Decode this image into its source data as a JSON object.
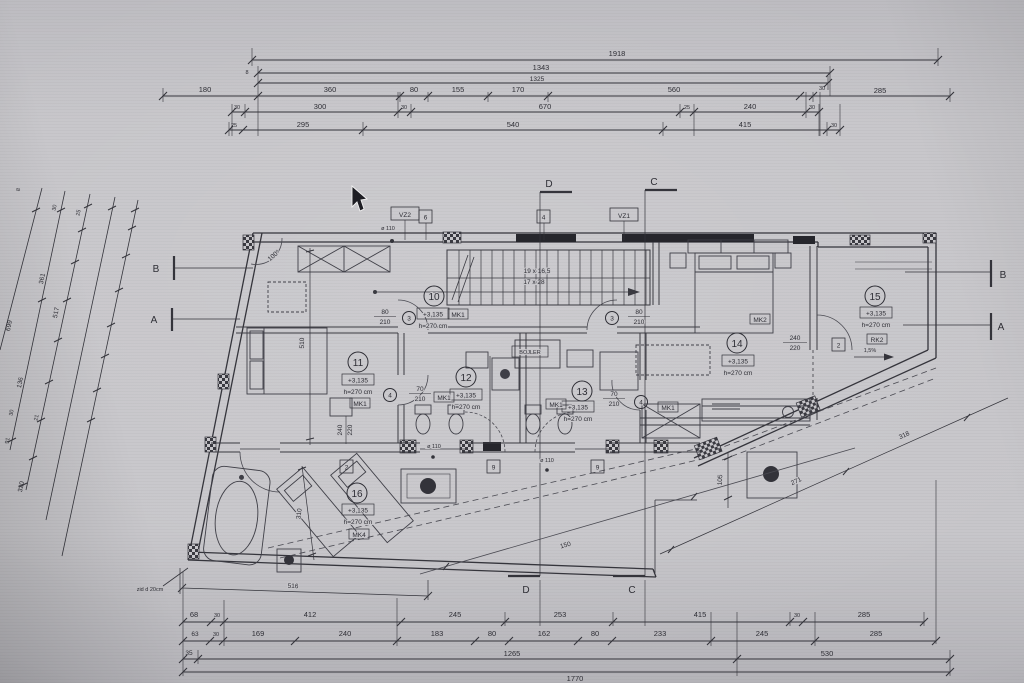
{
  "top": {
    "r1": [
      "1918"
    ],
    "r2": [
      "1343"
    ],
    "r3": [
      "1325"
    ],
    "r4": [
      "180",
      "360",
      "80",
      "155",
      "170",
      "560",
      "30",
      "285"
    ],
    "r5": [
      "30",
      "300",
      "30",
      "670",
      "25",
      "240",
      "30"
    ],
    "r6": [
      "25",
      "295",
      "540",
      "415",
      "30"
    ],
    "tick8": "8"
  },
  "bottom": {
    "r1": [
      "68",
      "30",
      "412",
      "245",
      "253",
      "415",
      "30",
      "285"
    ],
    "r2": [
      "63",
      "30",
      "169",
      "240",
      "183",
      "80",
      "162",
      "80",
      "233",
      "245",
      "285"
    ],
    "r3": [
      "35",
      "1265",
      "530"
    ],
    "r4": [
      "1770"
    ]
  },
  "left": [
    "8",
    "30",
    "25",
    "361",
    "517",
    "699",
    "136",
    "30",
    "21",
    "91",
    "320"
  ],
  "sections": {
    "a": "A",
    "b": "B",
    "c": "C",
    "d": "D"
  },
  "rooms": {
    "n10": "10",
    "n11": "11",
    "n12": "12",
    "n13": "13",
    "n14": "14",
    "n15": "15",
    "n16": "16"
  },
  "levels": {
    "value": "+3,135",
    "height": "h=270 cm"
  },
  "tags": {
    "mk1": "MK1",
    "mk2": "MK2",
    "mk4": "MK4",
    "rk2": "RK2",
    "vz1": "VZ1",
    "vz2": "VZ2",
    "bojler": "BOJLER"
  },
  "doors": {
    "w80": "80",
    "w70": "70",
    "h210": "210",
    "w240": "240",
    "h220": "220",
    "c3": "3",
    "c4": "4",
    "b2": "2",
    "b4": "4",
    "b6": "6",
    "b9": "9"
  },
  "stairs": {
    "l1": "19 x 16,5",
    "l2": "17 x 28"
  },
  "notes": {
    "slope": "1,5%",
    "angle": "100°",
    "drain": "ø 110",
    "wall_note": "zid d 20cm"
  },
  "plan_dims": {
    "v510": "510",
    "v310": "310",
    "b516": "516",
    "d150": "150",
    "v105": "105",
    "d271": "271",
    "d318": "318"
  }
}
